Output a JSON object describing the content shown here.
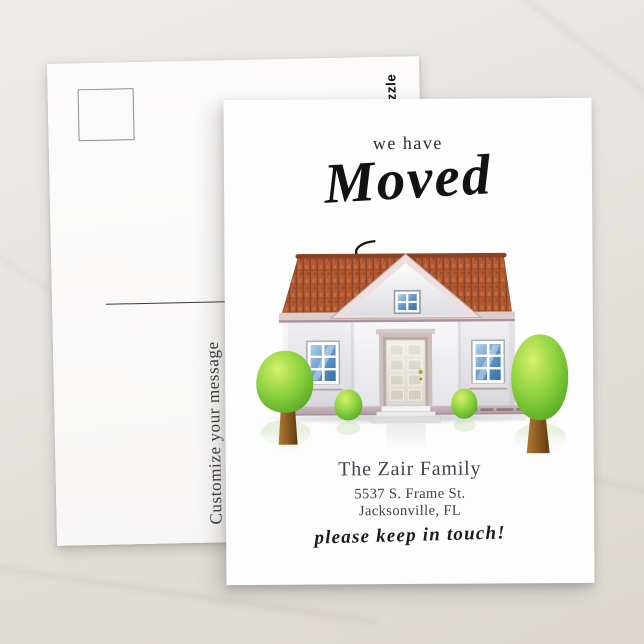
{
  "back_card": {
    "watermark": "zazzle",
    "message_placeholder": "Customize your message"
  },
  "front_card": {
    "intro": "we have",
    "headline": "Moved",
    "family_name": "The Zair Family",
    "address_line1": "5537 S. Frame St.",
    "address_line2": "Jacksonville, FL",
    "tagline": "please keep in touch!"
  },
  "colors": {
    "background_marble": "#e4e1dd",
    "card_white": "#fdfdfd",
    "roof_terracotta": "#b45a32",
    "roof_dark_line": "#8a4526",
    "wall_gray": "#ececf0",
    "trim_mauve": "#c9b6b4",
    "base_mauve": "#b9a7ad",
    "window_glass_blue": "#5e93c4",
    "tree_green": "#7cc637",
    "tree_highlight": "#d7ef6a",
    "trunk_brown": "#8a5a22",
    "text_dark": "#2d2d2d",
    "name_slate": "#43434c"
  }
}
